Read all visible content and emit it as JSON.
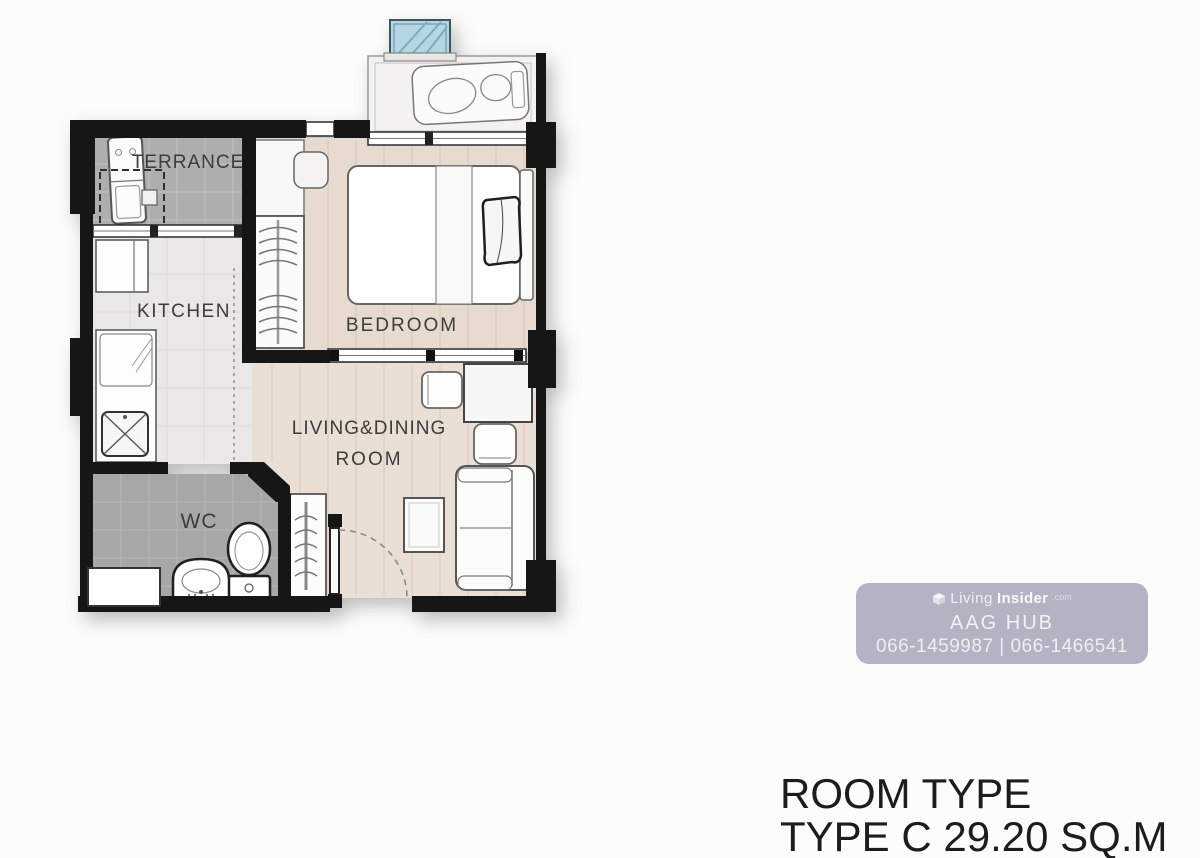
{
  "plan": {
    "rooms": {
      "terrace": {
        "label": "TERRANCE"
      },
      "kitchen": {
        "label": "KITCHEN"
      },
      "bedroom": {
        "label": "BEDROOM"
      },
      "living": {
        "label_line1": "LIVING&DINING",
        "label_line2": "ROOM"
      },
      "wc": {
        "label": "WC"
      }
    },
    "colors": {
      "wall": "#161616",
      "terrace_tile": "#aeaead",
      "wc_tile": "#a7a7a6",
      "kitchen_floor": "#e9e8e5",
      "bedroom_wood": "#e7dbd0",
      "living_wood": "#eadfd5",
      "balcony_floor": "#f3f2ef",
      "glass_blue": "#b5d7e4"
    }
  },
  "watermark": {
    "brand_prefix": "Living",
    "brand_bold": "Insider",
    "brand_suffix": ".com",
    "agency": "AAG HUB",
    "phones": "066-1459987 | 066-1466541",
    "bg": "#b5b3c3"
  },
  "caption": {
    "line1": "ROOM TYPE",
    "line2": "TYPE C 29.20 SQ.M"
  }
}
